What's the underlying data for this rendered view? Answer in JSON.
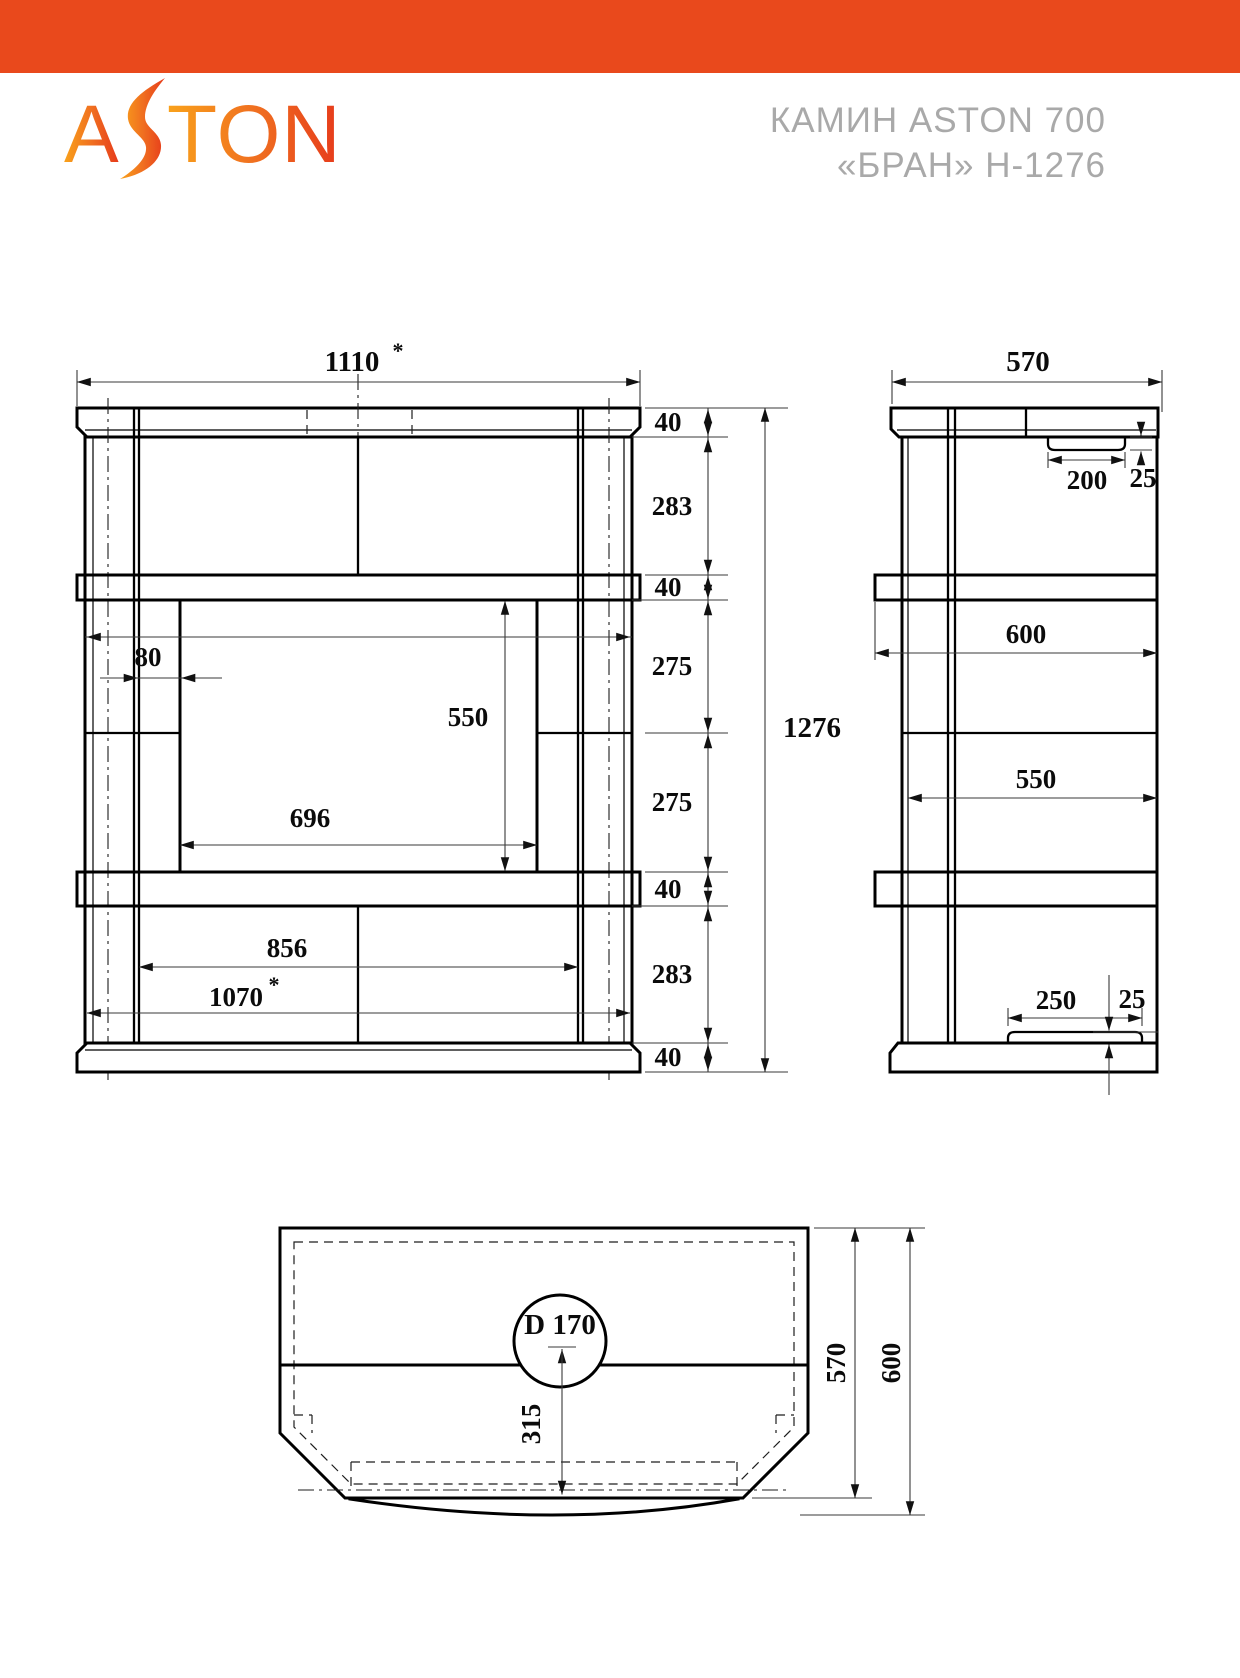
{
  "header": {
    "bar_color": "#E9491C",
    "logo_text_a": "A",
    "logo_text_ton": "TON",
    "title_line1": "КАМИН ASTON 700",
    "title_line2": "«БРАН» Н-1276",
    "title_color": "#A9A9A9",
    "logo_gradient_start": "#F9A21B",
    "logo_gradient_mid": "#F07020",
    "logo_gradient_end": "#E63A1B"
  },
  "front_view": {
    "label": "front-elevation",
    "dims": {
      "width_top": "1110",
      "star": "*",
      "chain": [
        "40",
        "283",
        "40",
        "275",
        "275",
        "40",
        "283",
        "40"
      ],
      "total_height": "1276",
      "pilaster_offset": "80",
      "opening_height": "550",
      "opening_width": "696",
      "inner_width": "856",
      "width_bottom": "1070"
    }
  },
  "side_view": {
    "label": "side-elevation",
    "dims": {
      "depth": "570",
      "recess_width": "200",
      "recess_depth": "25",
      "shelf_depth": "600",
      "body_depth": "550",
      "pad_width": "250",
      "pad_height": "25"
    }
  },
  "top_view": {
    "label": "plan-view",
    "dims": {
      "hole_diameter": "D 170",
      "hole_offset": "315",
      "depth_top": "570",
      "depth_overall": "600"
    }
  }
}
